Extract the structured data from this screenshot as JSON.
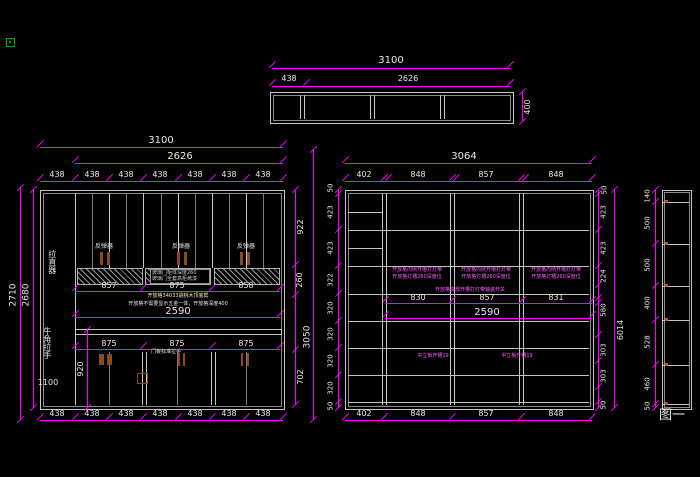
{
  "window": {
    "figure_label": "图一"
  },
  "top_view": {
    "overall": "3100",
    "seg_left": "438",
    "seg_right": "2626",
    "depth": "400"
  },
  "left_elev": {
    "dim_overall_w": "3100",
    "dim_inner_w": "2626",
    "top_cols": [
      "438",
      "438",
      "438",
      "438",
      "438",
      "438",
      "438"
    ],
    "bottom_cols": [
      "438",
      "438",
      "438",
      "438",
      "438",
      "438",
      "438"
    ],
    "dim_left_outer": "2710",
    "dim_left_inner": "2680",
    "dim_right_1": "922",
    "dim_right_2": "260",
    "dim_right_3": "702",
    "dim_right_outer": "3050",
    "mid_row": [
      "857",
      "875",
      "858"
    ],
    "dim_2590": "2590",
    "lower_row": [
      "875",
      "875",
      "875"
    ],
    "dim_920": "920",
    "label_straightener": "拉直器",
    "label_horn_handle": "牛角拉手",
    "label_horn_handle_num": "1100",
    "label_rebounder": "反弹器",
    "glass_note_1": "玻璃门柜体深度260",
    "glass_note_2": "玻璃门全套高柜烤漆",
    "open_note_1": "开放格34033胡桃木顶底帮",
    "open_note_2": "开放格不需要显示五金一体，开放格深度400",
    "door_handle_note": "门板标准拉手"
  },
  "right_elev": {
    "dim_overall_w": "3064",
    "top_cols": [
      "402",
      "848",
      "857",
      "848"
    ],
    "bottom_cols": [
      "402",
      "848",
      "857",
      "848"
    ],
    "left_chain": [
      "50",
      "423",
      "423",
      "322",
      "320",
      "320",
      "320",
      "320",
      "50"
    ],
    "right_chain": [
      "50",
      "423",
      "423",
      "224",
      "580",
      "303",
      "303",
      "50"
    ],
    "dim_right_outer": "6014",
    "shelf_note_1": "开放格内侧开槽打灯带",
    "shelf_note_2": "开放格灯槽260深度位",
    "center_note": "开放格底部开槽打灯带轴装开关",
    "mid_row": [
      "830",
      "857",
      "831"
    ],
    "dim_2590": "2590",
    "slot_note": "中立板开槽19"
  },
  "side_view": {
    "chain": [
      "140",
      "500",
      "500",
      "400",
      "528",
      "460",
      "50"
    ]
  }
}
